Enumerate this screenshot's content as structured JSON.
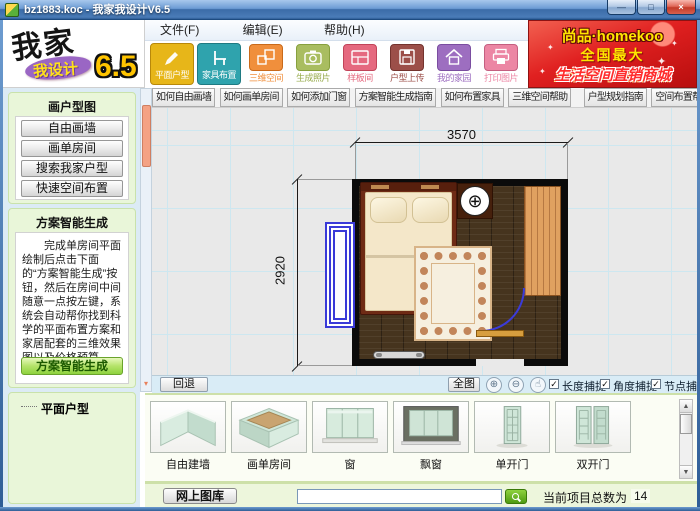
{
  "window": {
    "title": "bz1883.koc - 我家我设计V6.5",
    "controls": {
      "minimize": "—",
      "maximize": "□",
      "close": "×"
    }
  },
  "menu": {
    "items": [
      "文件(F)",
      "编辑(E)",
      "帮助(H)"
    ]
  },
  "logo": {
    "part1": "我家",
    "part2": "我设计",
    "version": "6.5"
  },
  "toolbar": {
    "buttons": [
      {
        "label": "平面户型",
        "icon": "pencil-icon",
        "color": "#e7b619",
        "active": true
      },
      {
        "label": "家具布置",
        "icon": "chair-icon",
        "color": "#2fa3ad",
        "active": true
      },
      {
        "label": "三维空间",
        "icon": "cubes-icon",
        "color": "#f08f3c",
        "active": false
      },
      {
        "label": "生成照片",
        "icon": "camera-icon",
        "color": "#a9bd60",
        "active": false
      },
      {
        "label": "样板间",
        "icon": "room-icon",
        "color": "#e5697f",
        "active": false
      },
      {
        "label": "户型上传",
        "icon": "floppy-icon",
        "color": "#9c4f49",
        "active": false
      },
      {
        "label": "我的家园",
        "icon": "house-icon",
        "color": "#9d6ec0",
        "active": false
      },
      {
        "label": "打印图片",
        "icon": "printer-icon",
        "color": "#ec86a4",
        "active": false
      }
    ]
  },
  "banner": {
    "line1": "尚品·homekoo",
    "line2": "全国最大",
    "line3": "生活空间直销商城",
    "bg_color": "#e02020",
    "text_color": "#ffe600"
  },
  "sidebar": {
    "draw": {
      "title": "画户型图",
      "buttons": [
        "自由画墙",
        "画单房间",
        "搜索我家户型",
        "快速空间布置"
      ]
    },
    "smart": {
      "title": "方案智能生成",
      "description": "完成单房间平面绘制后点击下面的“方案智能生成”按钮，然后在房间中间随意一点按左键，系统会自动帮你找到科学的平面布置方案和家居配套的三维效果图以及价格预算。",
      "button": "方案智能生成"
    },
    "tree_root": "平面户型"
  },
  "help_tabs": [
    "如何自由画墙",
    "如何画单房间",
    "如何添加门窗",
    "方案智能生成指南",
    "如何布置家具",
    "三维空间帮助",
    "户型规划指南",
    "空间布置帮助",
    "特惠空间直销"
  ],
  "canvas": {
    "dim_top": "3570",
    "dim_left": "2920"
  },
  "canvas_toolbar": {
    "back": "回退",
    "full_view": "全图",
    "snap_length": "长度捕捉",
    "snap_angle": "角度捕捉",
    "snap_node": "节点捕捉"
  },
  "library": {
    "items": [
      "自由建墙",
      "画单房间",
      "窗",
      "飘窗",
      "单开门",
      "双开门"
    ]
  },
  "statusbar": {
    "online_gallery": "网上图库",
    "search_value": "",
    "count_label": "当前项目总数为",
    "count_value": "14"
  },
  "icons": {
    "check": "✓",
    "lamp": "⊕",
    "zoom_in": "⊕",
    "zoom_out": "⊖",
    "pan": "☝",
    "scroll_up": "▲",
    "scroll_down": "▼",
    "thumb_down": "▾"
  }
}
